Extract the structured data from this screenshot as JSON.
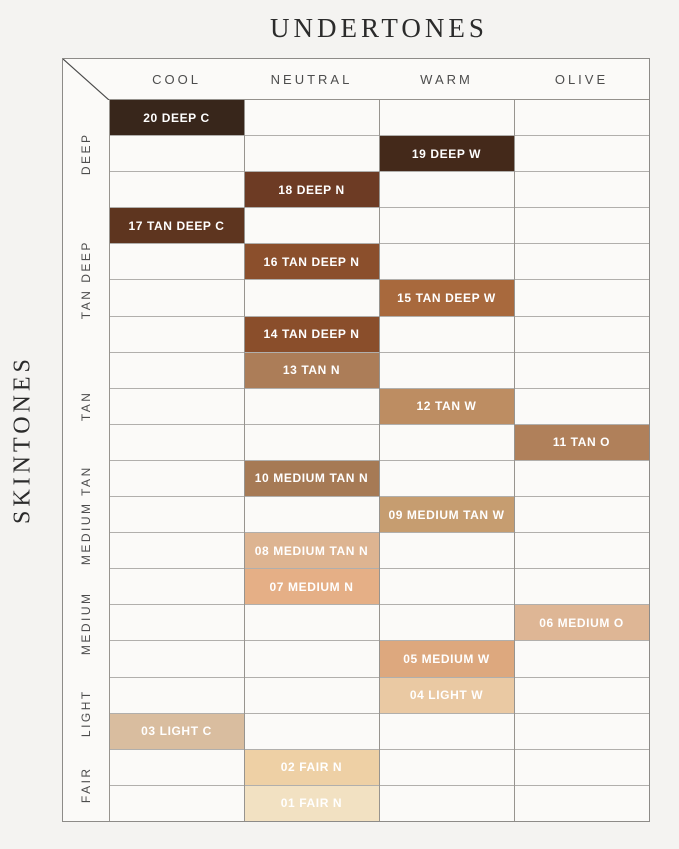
{
  "title": "UNDERTONES",
  "skintones_label": "SKINTONES",
  "chart_data": {
    "type": "heatmap",
    "title": "UNDERTONES",
    "ylabel": "SKINTONES",
    "x_categories": [
      "COOL",
      "NEUTRAL",
      "WARM",
      "OLIVE"
    ],
    "y_groups": [
      {
        "label": "DEEP",
        "row_span": 3
      },
      {
        "label": "TAN DEEP",
        "row_span": 4
      },
      {
        "label": "TAN",
        "row_span": 3
      },
      {
        "label": "MEDIUM TAN",
        "row_span": 3
      },
      {
        "label": "MEDIUM",
        "row_span": 3
      },
      {
        "label": "LIGHT",
        "row_span": 2
      },
      {
        "label": "FAIR",
        "row_span": 2
      }
    ],
    "rows": [
      {
        "shade": "20 DEEP C",
        "undertone": "COOL",
        "skintone": "DEEP",
        "color": "#38261b"
      },
      {
        "shade": "19 DEEP W",
        "undertone": "WARM",
        "skintone": "DEEP",
        "color": "#44291a"
      },
      {
        "shade": "18 DEEP N",
        "undertone": "NEUTRAL",
        "skintone": "DEEP",
        "color": "#6d3b24"
      },
      {
        "shade": "17 TAN DEEP C",
        "undertone": "COOL",
        "skintone": "TAN DEEP",
        "color": "#5e351f"
      },
      {
        "shade": "16 TAN DEEP N",
        "undertone": "NEUTRAL",
        "skintone": "TAN DEEP",
        "color": "#8b4f2c"
      },
      {
        "shade": "15 TAN DEEP W",
        "undertone": "WARM",
        "skintone": "TAN DEEP",
        "color": "#a8693d"
      },
      {
        "shade": "14 TAN DEEP N",
        "undertone": "NEUTRAL",
        "skintone": "TAN DEEP",
        "color": "#8a4e2b"
      },
      {
        "shade": "13 TAN N",
        "undertone": "NEUTRAL",
        "skintone": "TAN",
        "color": "#ac7d58"
      },
      {
        "shade": "12 TAN W",
        "undertone": "WARM",
        "skintone": "TAN",
        "color": "#bd8d62"
      },
      {
        "shade": "11 TAN O",
        "undertone": "OLIVE",
        "skintone": "TAN",
        "color": "#b0805a"
      },
      {
        "shade": "10 MEDIUM TAN N",
        "undertone": "NEUTRAL",
        "skintone": "MEDIUM TAN",
        "color": "#a67a55"
      },
      {
        "shade": "09 MEDIUM TAN W",
        "undertone": "WARM",
        "skintone": "MEDIUM TAN",
        "color": "#c69d70"
      },
      {
        "shade": "08 MEDIUM TAN N",
        "undertone": "NEUTRAL",
        "skintone": "MEDIUM TAN",
        "color": "#ddb491"
      },
      {
        "shade": "07 MEDIUM N",
        "undertone": "NEUTRAL",
        "skintone": "MEDIUM",
        "color": "#e5af86"
      },
      {
        "shade": "06 MEDIUM O",
        "undertone": "OLIVE",
        "skintone": "MEDIUM",
        "color": "#deb695"
      },
      {
        "shade": "05 MEDIUM W",
        "undertone": "WARM",
        "skintone": "MEDIUM",
        "color": "#dda87e"
      },
      {
        "shade": "04 LIGHT W",
        "undertone": "WARM",
        "skintone": "LIGHT",
        "color": "#eac9a3"
      },
      {
        "shade": "03 LIGHT C",
        "undertone": "COOL",
        "skintone": "LIGHT",
        "color": "#d9bd9f"
      },
      {
        "shade": "02 FAIR N",
        "undertone": "NEUTRAL",
        "skintone": "FAIR",
        "color": "#eed0a5"
      },
      {
        "shade": "01 FAIR N",
        "undertone": "NEUTRAL",
        "skintone": "FAIR",
        "color": "#f2e1c2"
      }
    ],
    "legend": "none",
    "grid": "on"
  },
  "colors": {
    "page_background": "#f4f3f1",
    "cell_background": "#fbfaf8",
    "swatch_text": "#ffffff"
  }
}
